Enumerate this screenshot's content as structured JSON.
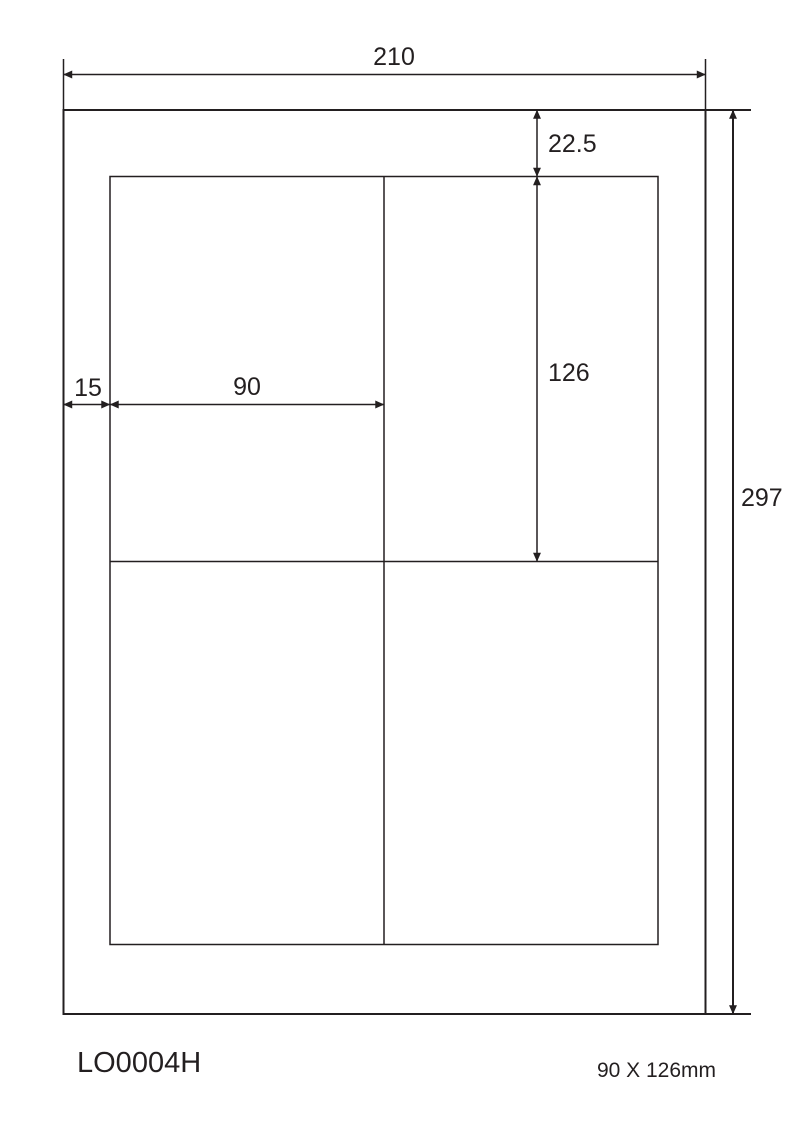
{
  "diagram": {
    "product_code": "LO0004H",
    "label_size_caption": "90 X 126mm",
    "dims": {
      "page_width": "210",
      "page_height": "297",
      "top_margin": "22.5",
      "label_height": "126",
      "label_width": "90",
      "left_margin": "15"
    },
    "grid": {
      "rows": 2,
      "columns": 2,
      "labels_per_sheet": 4
    },
    "colors": {
      "line": "#231f20",
      "background": "#ffffff"
    }
  }
}
